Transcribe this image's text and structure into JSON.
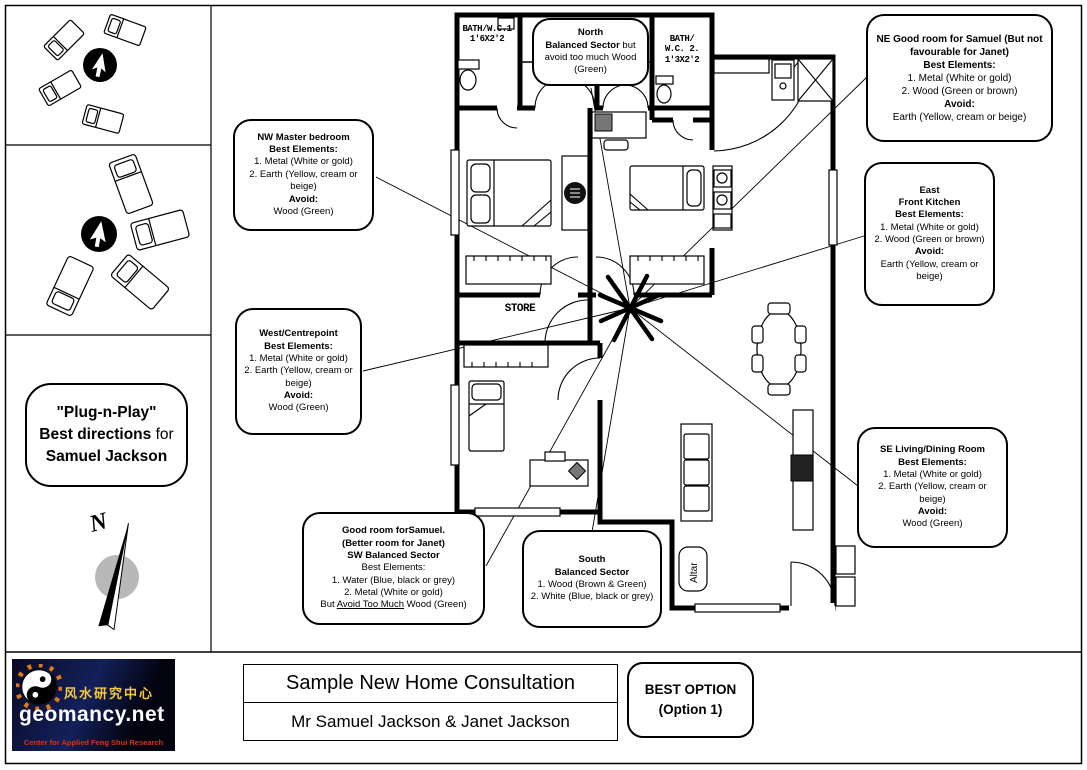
{
  "titlebar": {
    "title": "Sample New Home Consultation",
    "subtitle": "Mr Samuel Jackson & Janet Jackson",
    "best_option_line1": "BEST OPTION",
    "best_option_line2": "(Option 1)"
  },
  "logo": {
    "chinese": "风水研究中心",
    "site": "geomancy.net",
    "tagline": "Center for Applied Feng Shui Research"
  },
  "plug": {
    "line1": "\"Plug-n-Play\"",
    "line2_bold": "Best directions",
    "line2_tail": " for",
    "line3": "Samuel Jackson"
  },
  "compass": {
    "north": "N"
  },
  "plan": {
    "bath1_line1": "BATH/W.C.1",
    "bath1_line2": "1'6X2'2",
    "bath2_line1": "BATH/",
    "bath2_line2": "W.C. 2.",
    "bath2_line3": "1'3X2'2",
    "store": "STORE",
    "altar": "Altar"
  },
  "callouts": {
    "north": {
      "t1": "North",
      "t2b": "Balanced Sector",
      "t2r": " but",
      "t3": "avoid too much Wood",
      "t4": "(Green)"
    },
    "ne": {
      "t1": "NE Good room for Samuel (But not favourable for Janet)",
      "t2": "Best Elements:",
      "t3": "1. Metal (White or gold)",
      "t4": "2. Wood (Green or brown)",
      "t5": "Avoid:",
      "t6": "Earth (Yellow, cream or beige)"
    },
    "nw": {
      "t1": "NW Master bedroom",
      "t2": "Best Elements:",
      "t3": "1. Metal (White or gold)",
      "t4": "2. Earth (Yellow, cream or beige)",
      "t5": "Avoid:",
      "t6": "Wood (Green)"
    },
    "east": {
      "t1": "East",
      "t2": "Front Kitchen",
      "t3": "Best Elements:",
      "t4": "1. Metal (White or gold)",
      "t5": "2. Wood (Green or brown)",
      "t6": "Avoid:",
      "t7": "Earth (Yellow, cream or beige)"
    },
    "west": {
      "t1": "West/Centrepoint",
      "t2": "Best Elements:",
      "t3": "1. Metal (White or gold)",
      "t4": "2. Earth (Yellow, cream or beige)",
      "t5": "Avoid:",
      "t6": "Wood (Green)"
    },
    "se": {
      "t1": "SE Living/Dining Room",
      "t2": "Best Elements:",
      "t3": "1. Metal (White or gold)",
      "t4": "2. Earth (Yellow, cream or beige)",
      "t5": "Avoid:",
      "t6": "Wood (Green)"
    },
    "sw": {
      "t1": "Good room forSamuel.",
      "t2": "(Better room for Janet)",
      "t3": "SW Balanced Sector",
      "t4": "Best Elements:",
      "t5": "1. Water (Blue, black or grey)",
      "t6": "2. Metal (White or gold)",
      "t7a": "But ",
      "t7b": "Avoid Too Much",
      "t7c": " Wood (Green)"
    },
    "south": {
      "t1": "South",
      "t2": "Balanced Sector",
      "t3": "1. Wood (Brown & Green)",
      "t4": "2. White (Blue, black or grey)"
    }
  },
  "colors": {
    "wall": "#000000",
    "compass_circle": "#b8b8b8",
    "logo_bg": "#0a0f33",
    "logo_yellow": "#f6c83e",
    "logo_red": "#d8301a",
    "bagua_orange": "#e07818"
  }
}
